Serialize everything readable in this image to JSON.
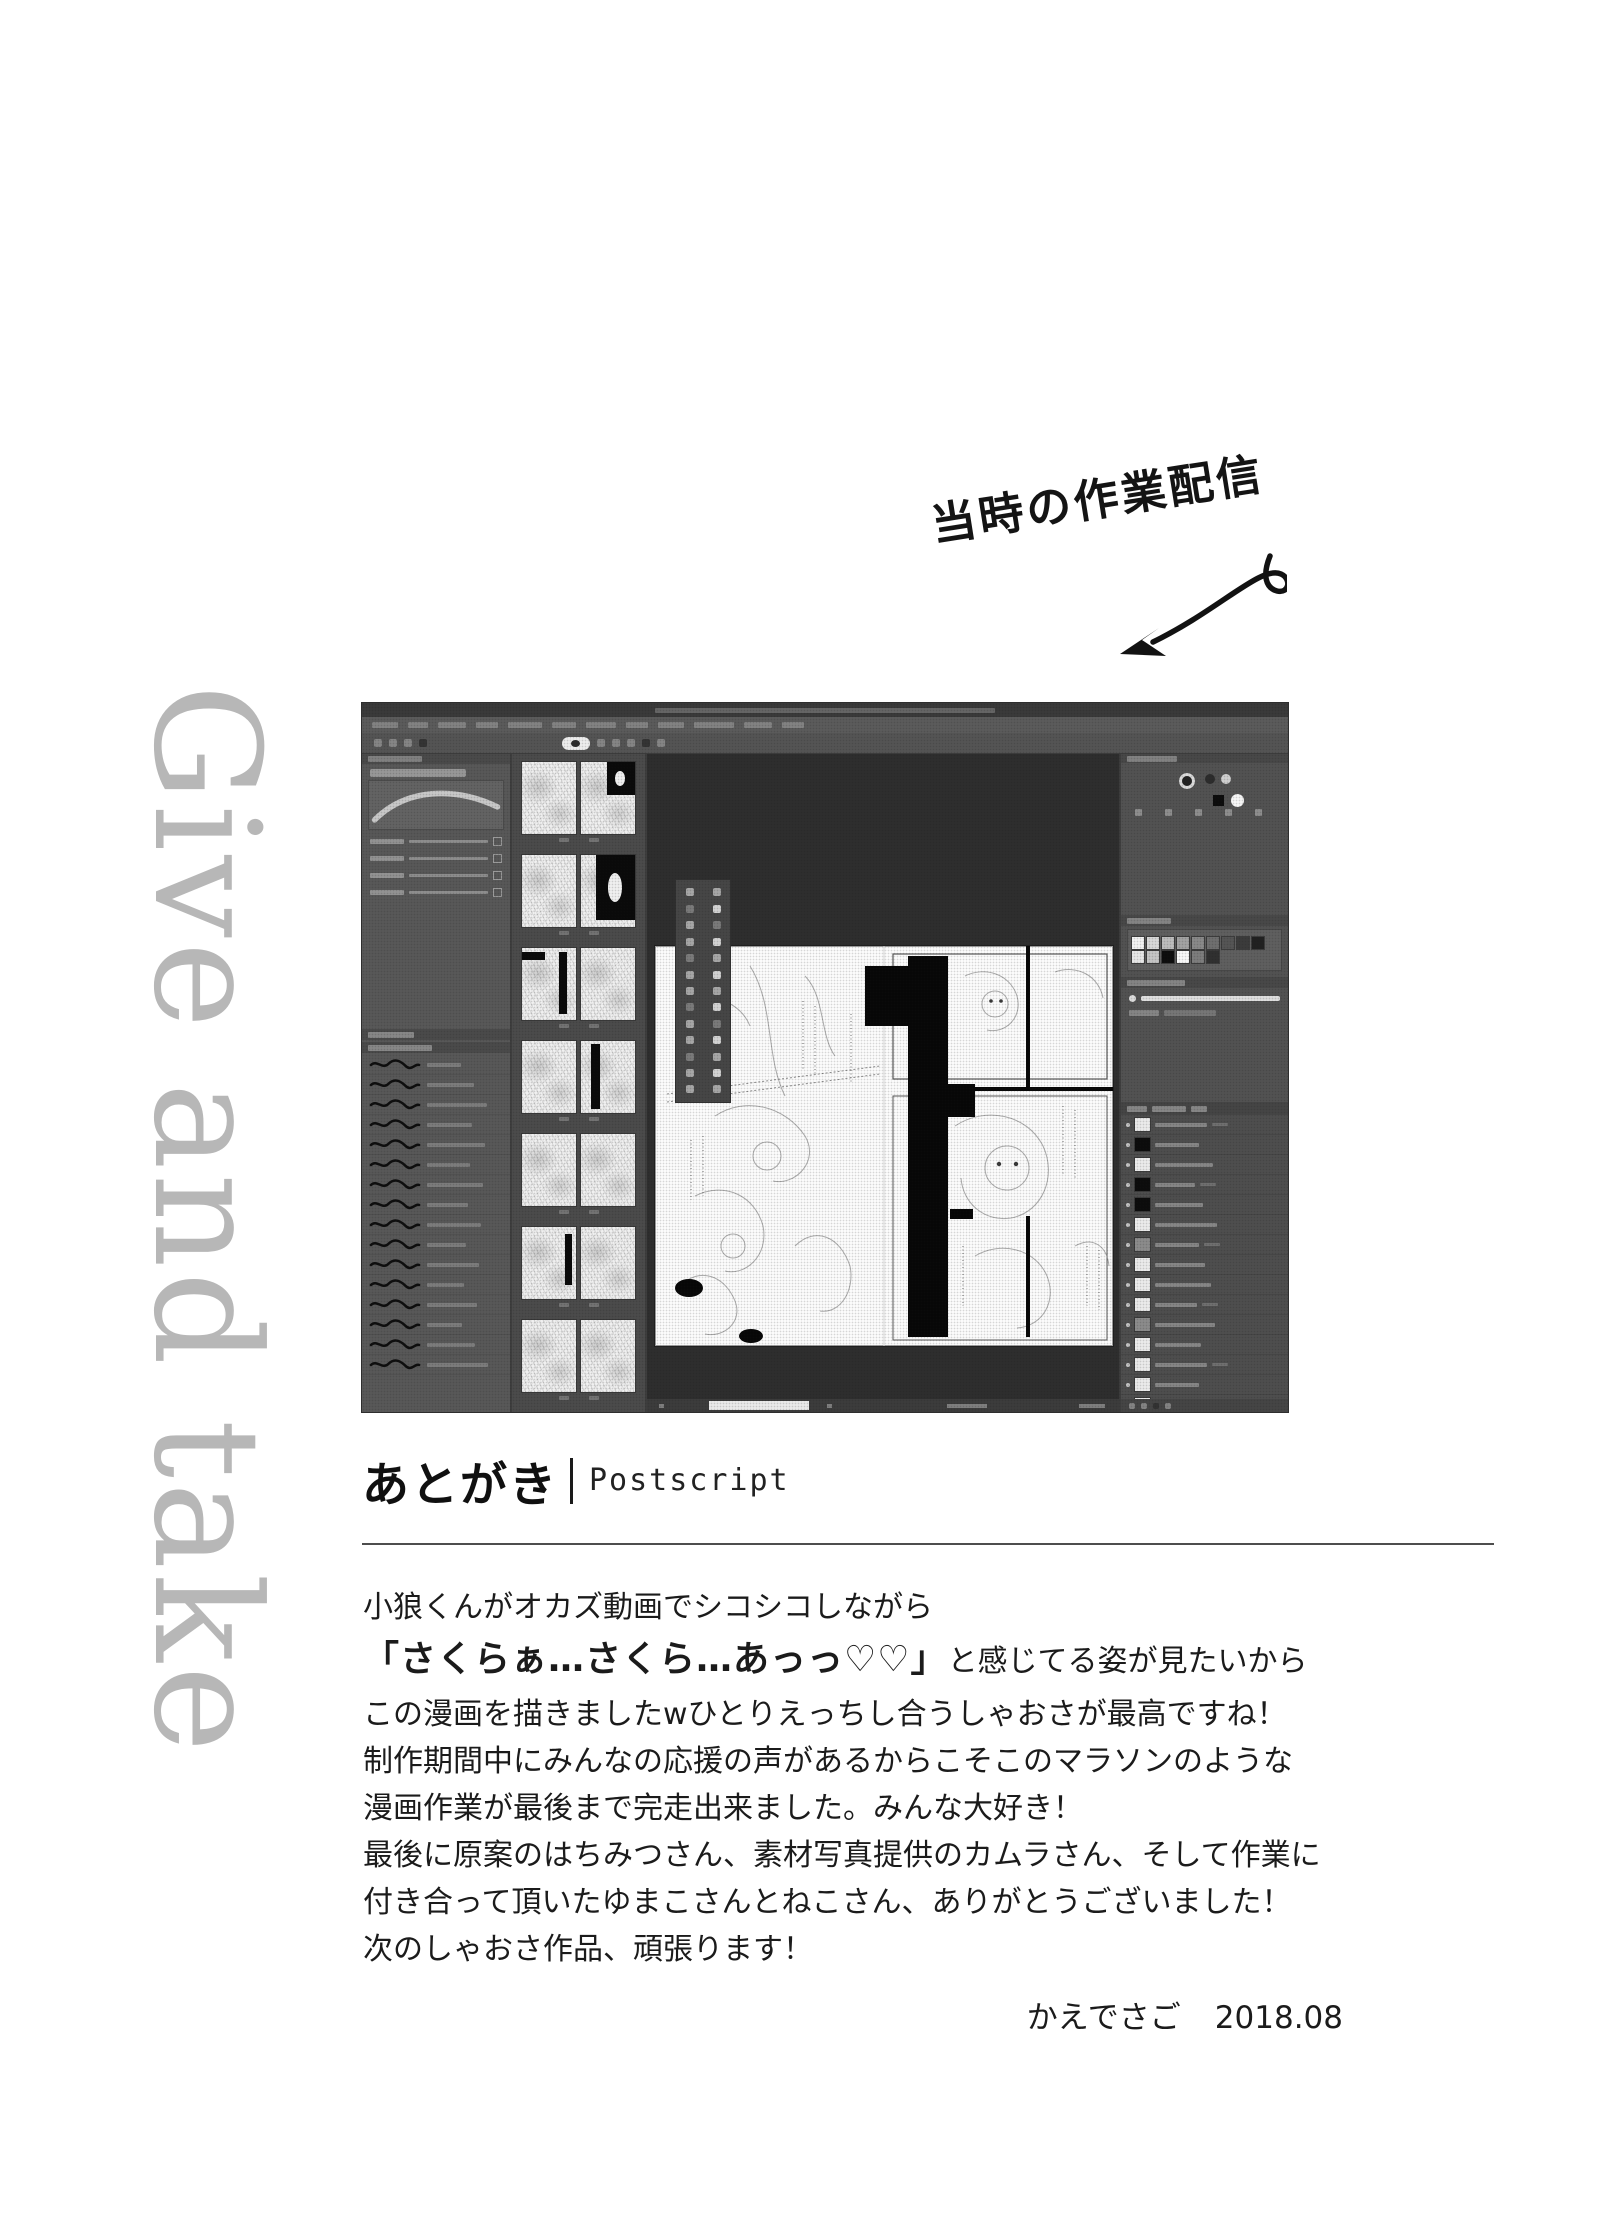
{
  "annotation": {
    "text": "当時の作業配信"
  },
  "side_text": {
    "text": "Give and take"
  },
  "postscript": {
    "heading_jp": "あとがき",
    "heading_en": "Postscript",
    "body": {
      "line1": "小狼くんがオカズ動画でシコシコしながら",
      "line2_bold": "「さくらぁ…さくら…あっっ♡♡」",
      "line2_rest": "と感じてる姿が見たいから",
      "line3": "この漫画を描きましたwひとりえっちし合うしゃおさが最高ですね！",
      "line4": "制作期間中にみんなの応援の声があるからこそこのマラソンのような",
      "line5": "漫画作業が最後まで完走出来ました。みんな大好き！",
      "line6": "最後に原案のはちみつさん、素材写真提供のカムラさん、そして作業に",
      "line7": "付き合って頂いたゆまこさんとねこさん、ありがとうございました！",
      "line8": "次のしゃおさ作品、頑張ります！"
    },
    "signature": {
      "name": "かえでさご",
      "date": "2018.08"
    }
  },
  "screenshot": {
    "decor": {
      "menu_chip_widths": [
        26,
        20,
        28,
        22,
        34,
        24,
        30,
        22,
        26,
        40,
        28,
        22
      ],
      "toolbar_dots": 9,
      "brush_rows": 16,
      "thumb_cells": 7,
      "palette_cells": 26,
      "layer_rows": 15,
      "layer_label_widths": [
        52,
        44,
        58,
        40,
        48,
        62,
        44,
        50,
        56,
        42,
        60,
        46,
        52,
        44,
        58
      ],
      "layer_dark_rows": [
        1,
        3,
        4
      ],
      "layer_mid_rows": [
        6,
        10
      ],
      "swatch_row1": [
        "#f2f2f2",
        "#d8d8d8",
        "#bdbdbd",
        "#a3a3a3",
        "#898989",
        "#6f6f6f",
        "#555555",
        "#3b3b3b",
        "#212121"
      ],
      "swatch_row2": [
        "#e6e6e6",
        "#c4c4c4",
        "#0d0d0d",
        "#f7f7f7",
        "#7d7d7d",
        "#303030"
      ]
    }
  }
}
